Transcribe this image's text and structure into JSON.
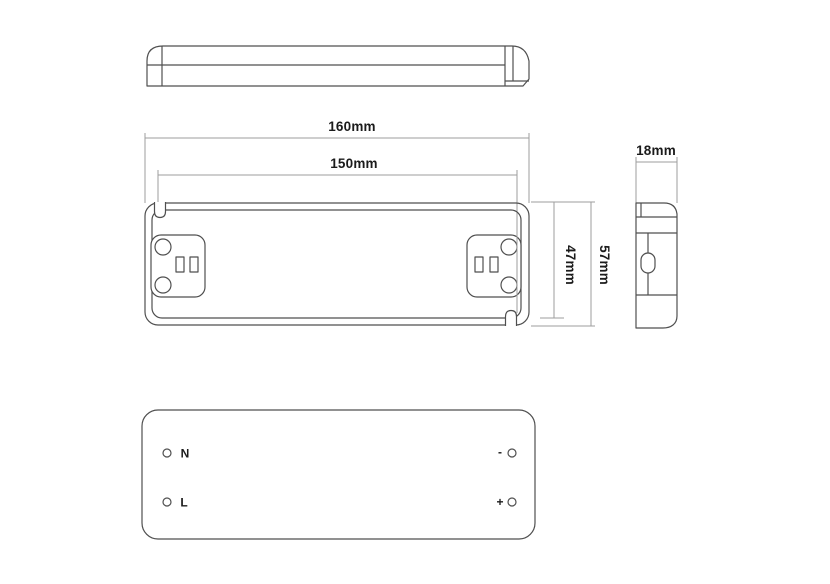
{
  "dimensions": {
    "overall_length": "160mm",
    "mounting_centers": "150mm",
    "body_width": "18mm",
    "inner_height": "47mm",
    "overall_height": "57mm"
  },
  "terminals": {
    "neutral": "N",
    "live": "L",
    "negative": "-",
    "positive": "+"
  },
  "colors": {
    "background": "#ffffff",
    "outline": "#4f4f4f",
    "dimension_line": "#9e9e9e",
    "label_text": "#1b1b1b"
  }
}
